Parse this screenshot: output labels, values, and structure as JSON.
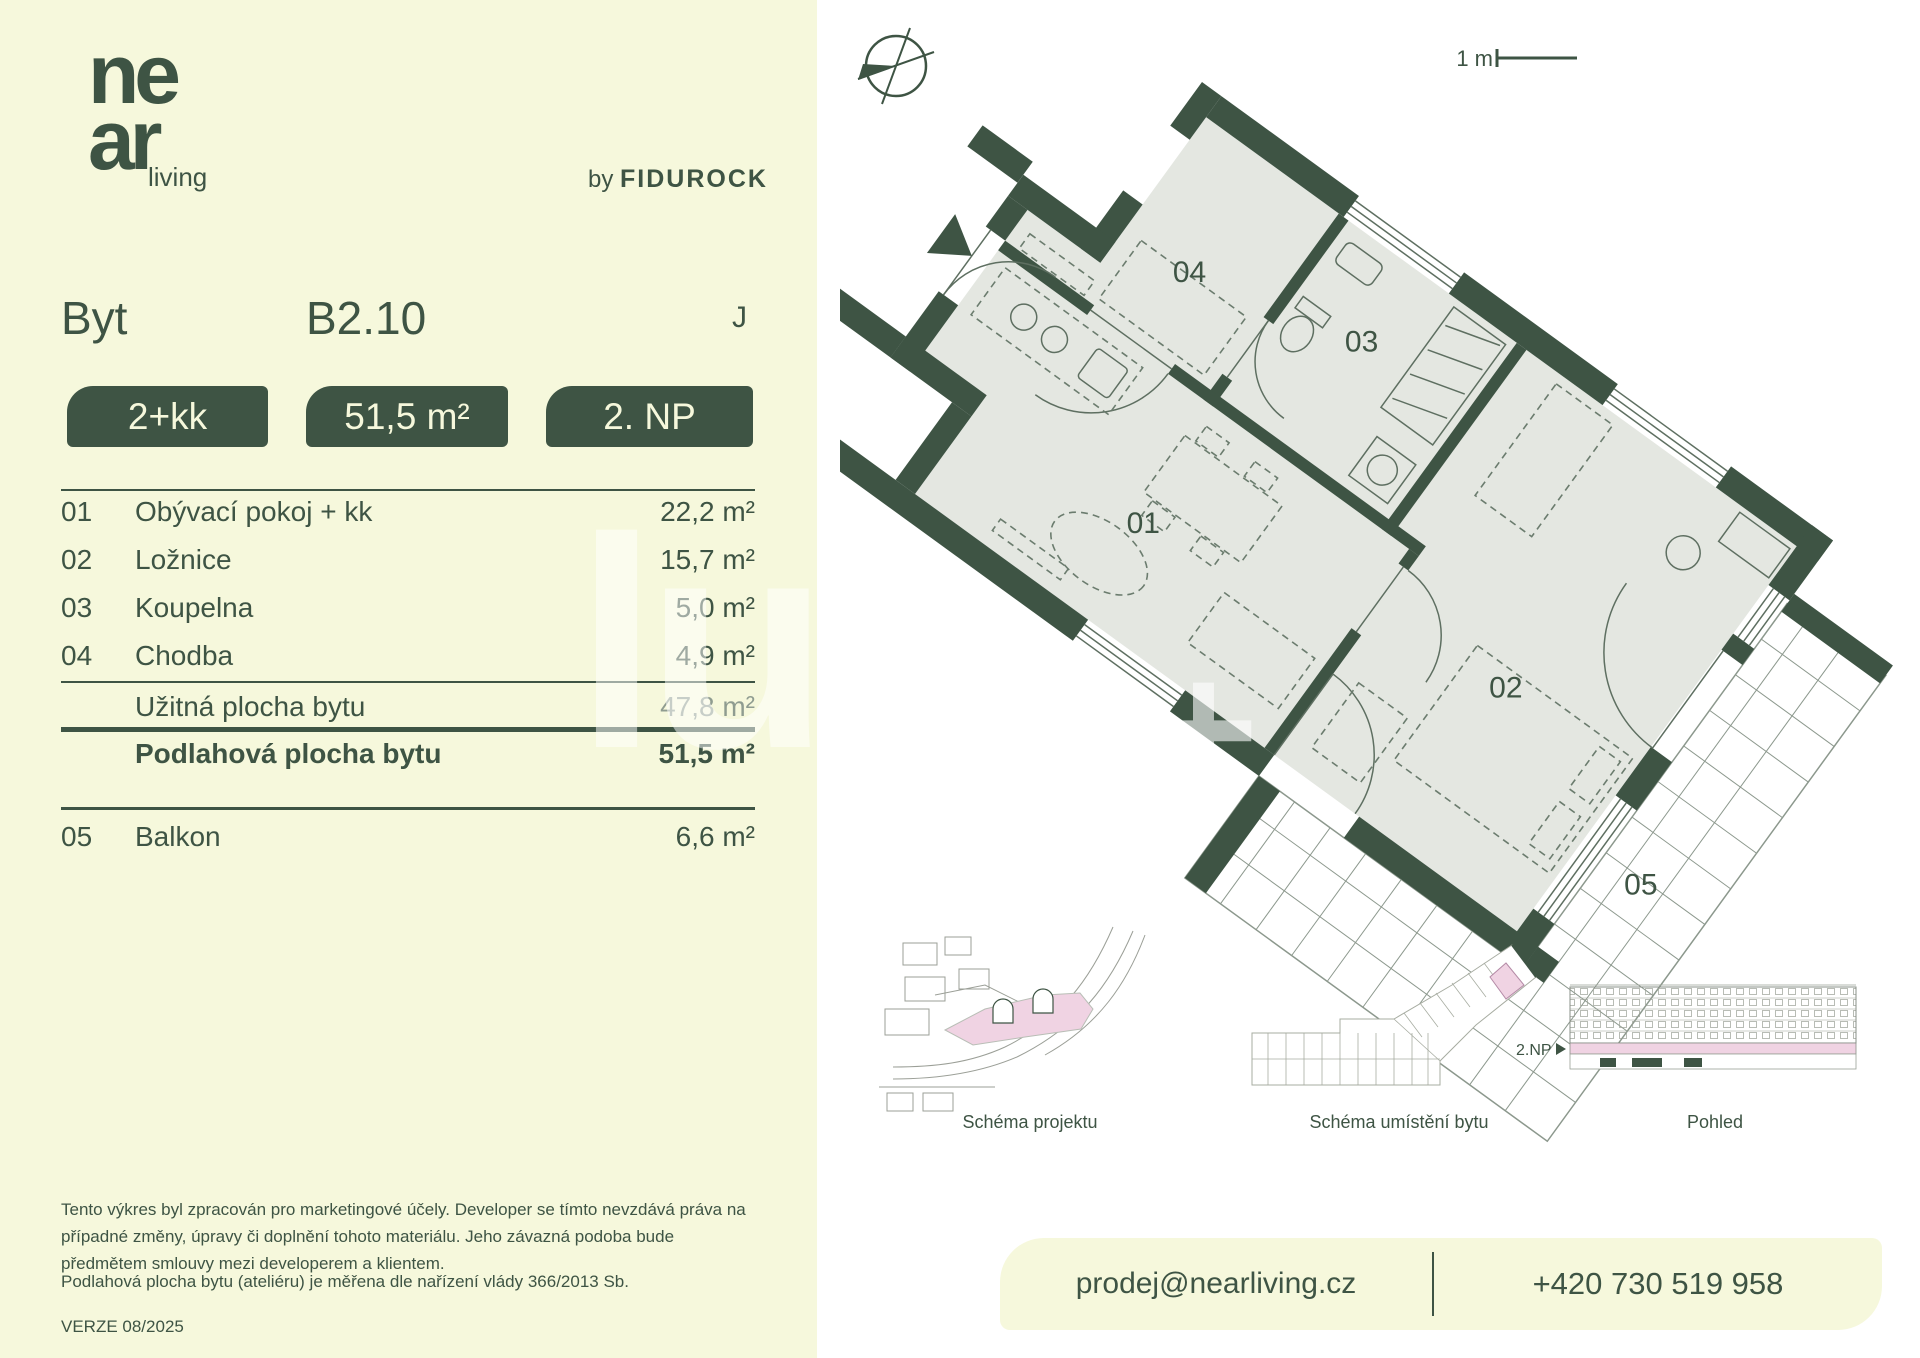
{
  "colors": {
    "accent_green": "#3E5444",
    "cream": "#F6F8DC",
    "floor_gray": "#E4E7E1",
    "highlight_pink": "#F0D3E3"
  },
  "brand": {
    "logo_top": "ne",
    "logo_bottom": "ar",
    "logo_suffix": "living",
    "byline_prefix": "by",
    "byline_brand": "FIDUROCK"
  },
  "header": {
    "type_label": "Byt",
    "unit_number": "B2.10",
    "orientation": "J"
  },
  "badges": [
    {
      "label": "2+kk"
    },
    {
      "label": "51,5 m²"
    },
    {
      "label": "2. NP"
    }
  ],
  "room_table": {
    "rows": [
      {
        "num": "01",
        "name": "Obývací pokoj + kk",
        "value": "22,2 m²"
      },
      {
        "num": "02",
        "name": "Ložnice",
        "value": "15,7 m²"
      },
      {
        "num": "03",
        "name": "Koupelna",
        "value": "5,0 m²"
      },
      {
        "num": "04",
        "name": "Chodba",
        "value": "4,9 m²"
      }
    ],
    "subtotal": {
      "label": "Užitná plocha bytu",
      "value": "47,8 m²"
    },
    "total": {
      "label": "Podlahová plocha bytu",
      "value": "51,5 m²"
    },
    "balcony": {
      "num": "05",
      "name": "Balkon",
      "value": "6,6 m²"
    }
  },
  "floorplan": {
    "scale_label": "1 m",
    "labels": {
      "living": "01",
      "bedroom": "02",
      "bathroom": "03",
      "hall": "04",
      "balcony": "05"
    }
  },
  "schematics": {
    "project": {
      "caption": "Schéma projektu"
    },
    "unit_location": {
      "caption": "Schéma umístění bytu"
    },
    "elevation": {
      "caption": "Pohled",
      "floor_marker": "2.NP"
    }
  },
  "legal": {
    "disclaimer": "Tento výkres byl zpracován pro marketingové účely. Developer se tímto nevzdává práva na případné změny, úpravy či doplnění tohoto materiálu. Jeho závazná podoba bude předmětem smlouvy mezi developerem a klientem.",
    "measurement_note": "Podlahová plocha bytu (ateliéru) je měřena dle nařízení vlády 366/2013 Sb.",
    "version": "VERZE 08/2025"
  },
  "contact": {
    "email": "prodej@nearliving.cz",
    "phone": "+420 730 519 958"
  },
  "watermark": {
    "panel_glyphs": "lu",
    "plan_glyph": "+"
  }
}
